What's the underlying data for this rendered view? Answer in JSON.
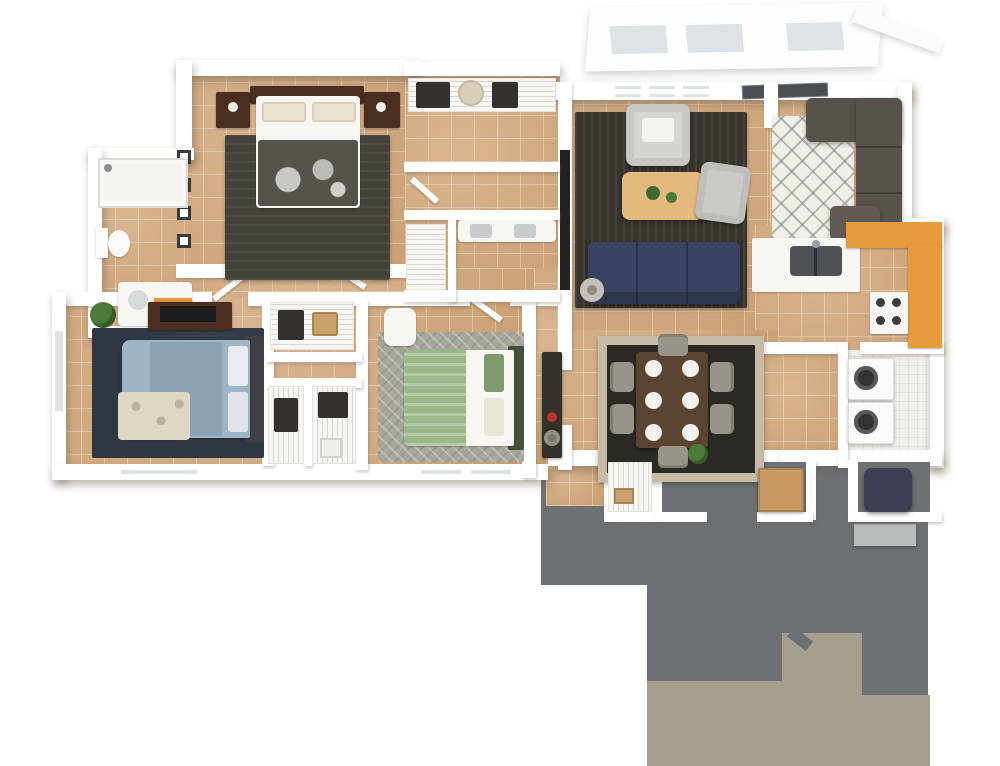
{
  "scene": {
    "type": "3d-floor-plan-render",
    "view": "top-down perspective of a multi-bedroom apartment",
    "background": "#ffffff",
    "visible_text": "none"
  },
  "palette": {
    "floor_tan": "#d2a77a",
    "wall_white": "#ffffff",
    "patio_gray": "#6e7174",
    "walkway_khaki": "#a79f8e",
    "rug_charcoal": "#37342e",
    "sofa_navy": "#3a4462",
    "coffee_table_tan": "#e3b97d",
    "armchair_gray": "#d6d4d0",
    "sectional_taupe": "#57524b",
    "accent_orange": "#e59a3d",
    "dining_table_brown": "#5c4434",
    "chair_gray": "#98948a",
    "rug_navy": "#2e3743",
    "bed_blue": "#9fb4c5",
    "bed_green": "#9cb88b",
    "wood_dark": "#4a2f20",
    "rug_dining_border": "#c6bba7",
    "rug_dining_center": "#2c2a25",
    "rug_diamond_bg": "#f0efe7",
    "rug_b3_gray": "#a9a79d",
    "water_heater_navy": "#3e3e55",
    "glass_gray": "#4a4f53",
    "step_gray": "#b9bcbd",
    "laundry_floor": "#f1efec",
    "plant_green": "#4d7a3a"
  },
  "rooms": [
    {
      "id": "master-bedroom",
      "furniture": [
        "dark-wood-bed",
        "two-nightstands",
        "charcoal-rug",
        "wall-frames"
      ]
    },
    {
      "id": "master-bathroom",
      "furniture": [
        "shower",
        "toilet",
        "vanity-orange-cabinet"
      ]
    },
    {
      "id": "walk-in-closet",
      "furniture": [
        "wire-shelving",
        "hanging-clothes",
        "hat-box"
      ]
    },
    {
      "id": "hall-bathroom",
      "furniture": [
        "double-vanity",
        "linen-closet"
      ]
    },
    {
      "id": "bedroom-2",
      "furniture": [
        "blue-bed",
        "navy-rug",
        "dresser-tv",
        "plant",
        "window"
      ]
    },
    {
      "id": "hall-closets",
      "furniture": [
        "wire-shelving",
        "hanging-clothes",
        "hamper"
      ]
    },
    {
      "id": "bedroom-3",
      "furniture": [
        "green-white-bed",
        "gray-rug",
        "desk-chair"
      ]
    },
    {
      "id": "living-room",
      "furniture": [
        "navy-sofa",
        "tan-coffee-table",
        "two-gray-armchairs",
        "tv-wall",
        "floor-lamp",
        "windows"
      ]
    },
    {
      "id": "entry-nook",
      "furniture": [
        "taupe-sectional",
        "diamond-rug",
        "glass-patio-door"
      ]
    },
    {
      "id": "kitchen",
      "furniture": [
        "white-peninsula-with-sink",
        "orange-l-counter",
        "stove"
      ]
    },
    {
      "id": "dining-room",
      "furniture": [
        "brown-table",
        "six-chairs",
        "six-plates",
        "bordered-rug",
        "console"
      ]
    },
    {
      "id": "laundry",
      "furniture": [
        "washer",
        "dryer"
      ]
    },
    {
      "id": "entry-hall",
      "furniture": [
        "wire-closet",
        "porch-cabinet"
      ]
    },
    {
      "id": "storage-closet",
      "furniture": [
        "water-heater"
      ]
    }
  ],
  "outdoor": {
    "patio": "dark gray concrete, stepped outline",
    "walkway": "khaki stepped path at bottom",
    "stoop": "small gray step",
    "upper_canopy": "white balcony band with three window panes"
  }
}
